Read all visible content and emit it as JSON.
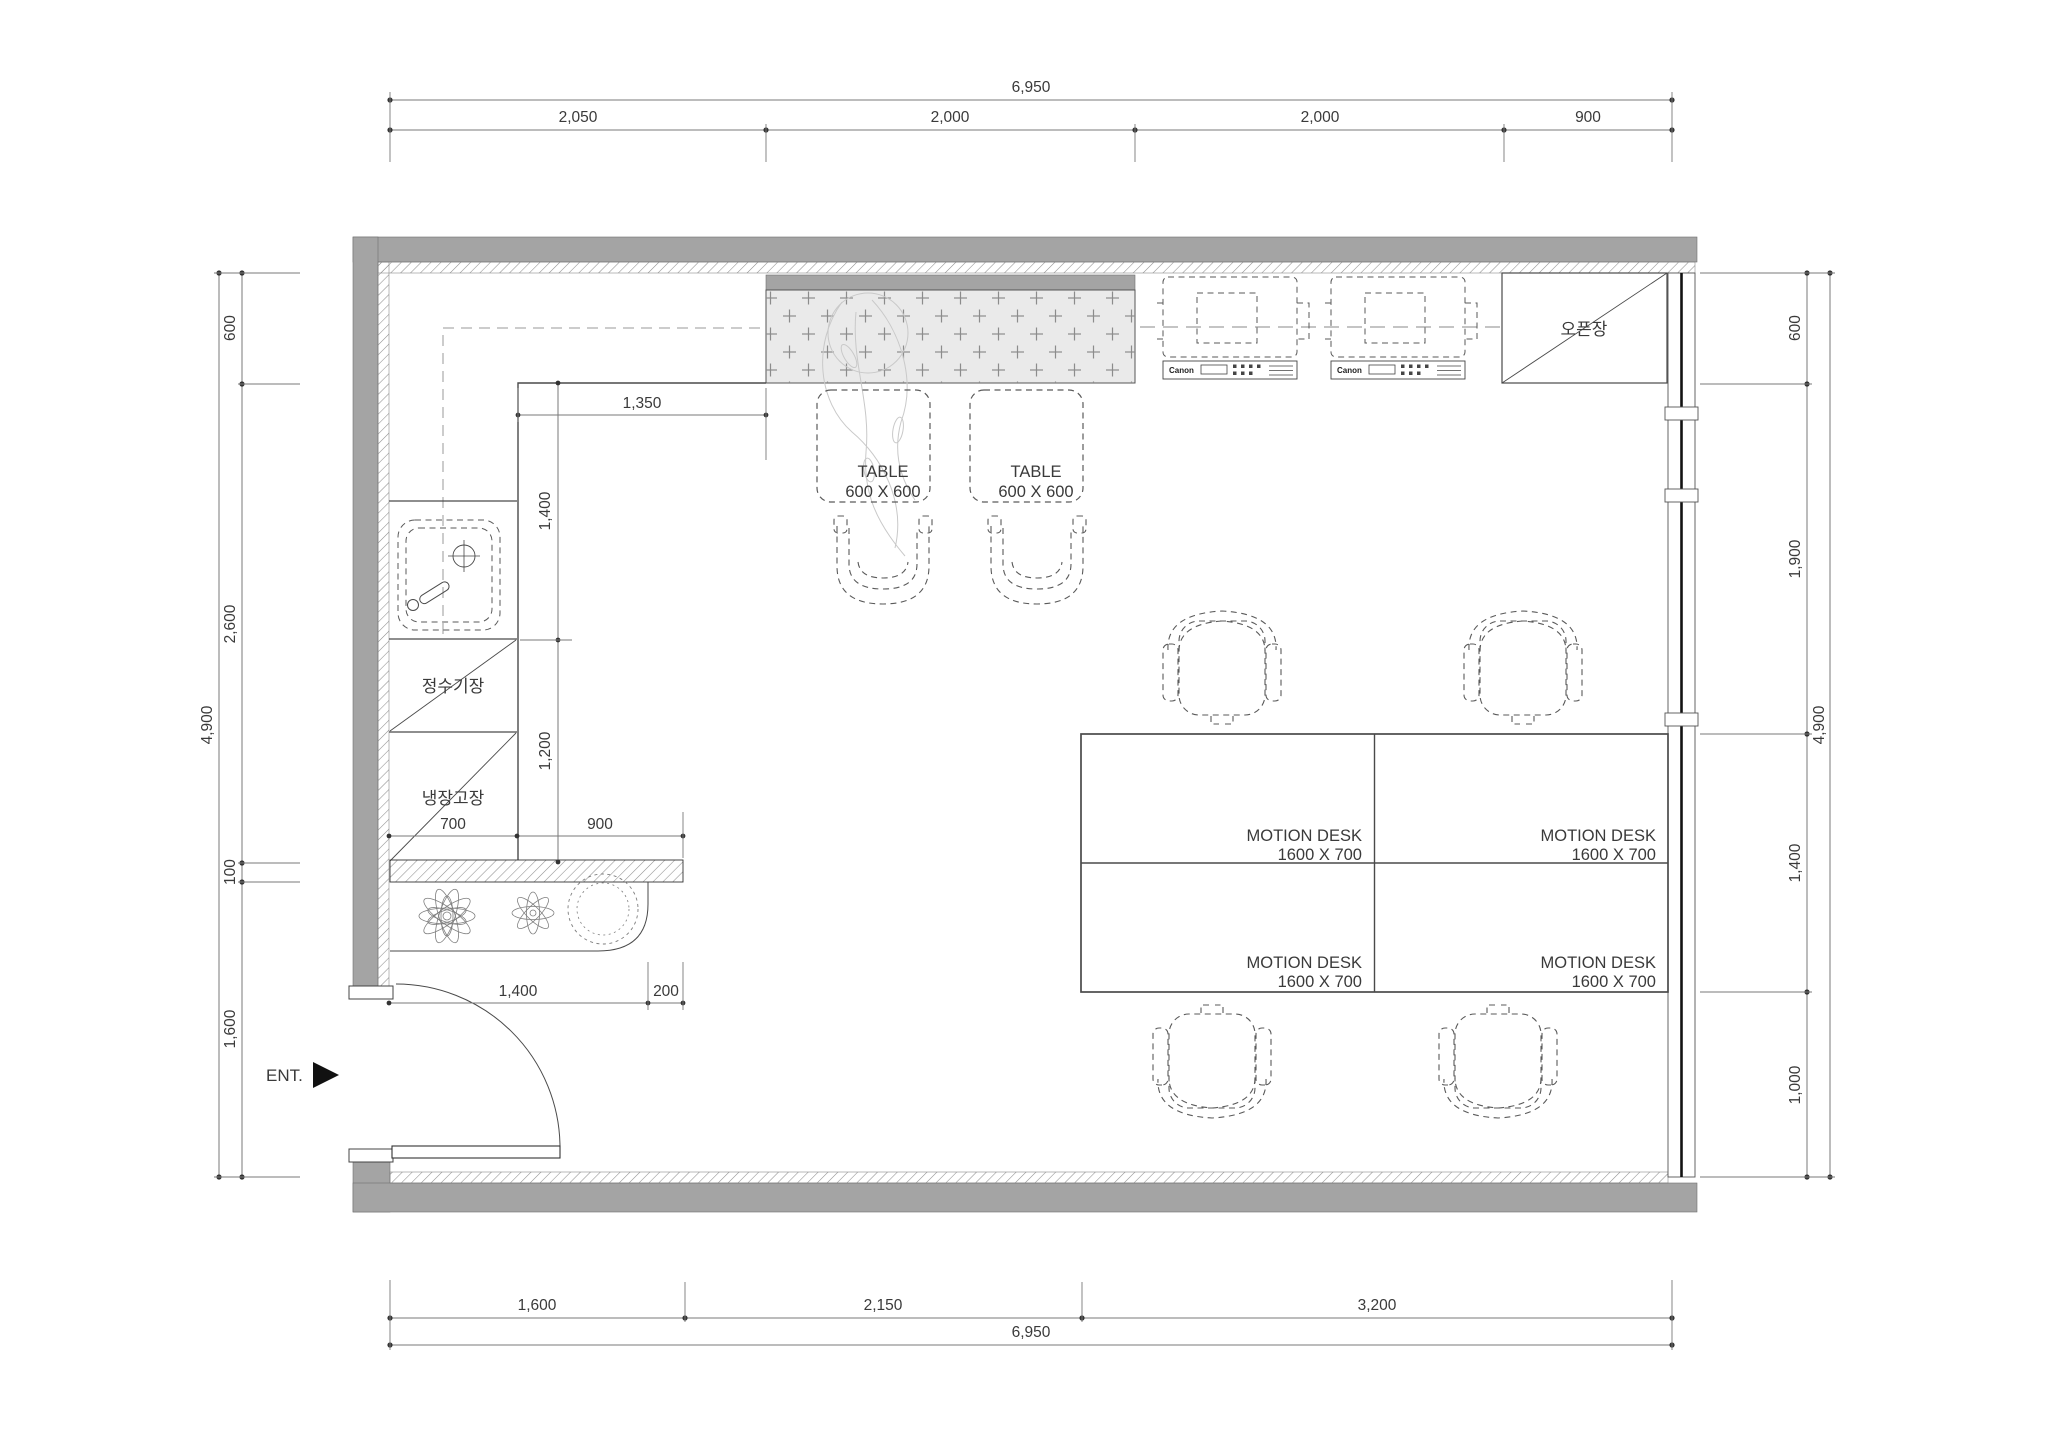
{
  "colors": {
    "wall": "#a4a4a4",
    "ink": "#3a3a3a",
    "line": "#4a4a4a",
    "dimline": "#7a7a7a",
    "dash": "#8a8a8a",
    "tile": "#eaeaea",
    "faint": "#c9c9c9"
  },
  "dims": {
    "top": {
      "overall": "6,950",
      "segments": [
        "2,050",
        "2,000",
        "2,000",
        "900"
      ]
    },
    "bottom": {
      "overall": "6,950",
      "segments": [
        "1,600",
        "2,150",
        "3,200"
      ]
    },
    "left": {
      "overall": "4,900",
      "segments": [
        "600",
        "2,600",
        "100",
        "1,600"
      ]
    },
    "right": {
      "overall": "4,900",
      "segments": [
        "600",
        "1,900",
        "1,400",
        "1,000"
      ]
    },
    "interior": {
      "counter_run": "1,350",
      "counter_depth": "1,400",
      "lower_counter": "1,200",
      "cabinet_width": "700",
      "counter_ext": "900",
      "planter_width": "1,400",
      "planter_ext": "200"
    }
  },
  "labels": {
    "entrance": "ENT.",
    "open_cabinet": "오픈장",
    "water_purifier_cabinet": "정수기장",
    "refrigerator_cabinet": "냉장고장"
  },
  "tables": [
    {
      "name": "TABLE",
      "size": "600 X 600"
    },
    {
      "name": "TABLE",
      "size": "600 X 600"
    }
  ],
  "desks": [
    {
      "name": "MOTION DESK",
      "size": "1600 X 700"
    },
    {
      "name": "MOTION DESK",
      "size": "1600 X 700"
    },
    {
      "name": "MOTION DESK",
      "size": "1600 X 700"
    },
    {
      "name": "MOTION DESK",
      "size": "1600 X 700"
    }
  ],
  "printers": [
    {
      "brand": "Canon"
    },
    {
      "brand": "Canon"
    }
  ]
}
